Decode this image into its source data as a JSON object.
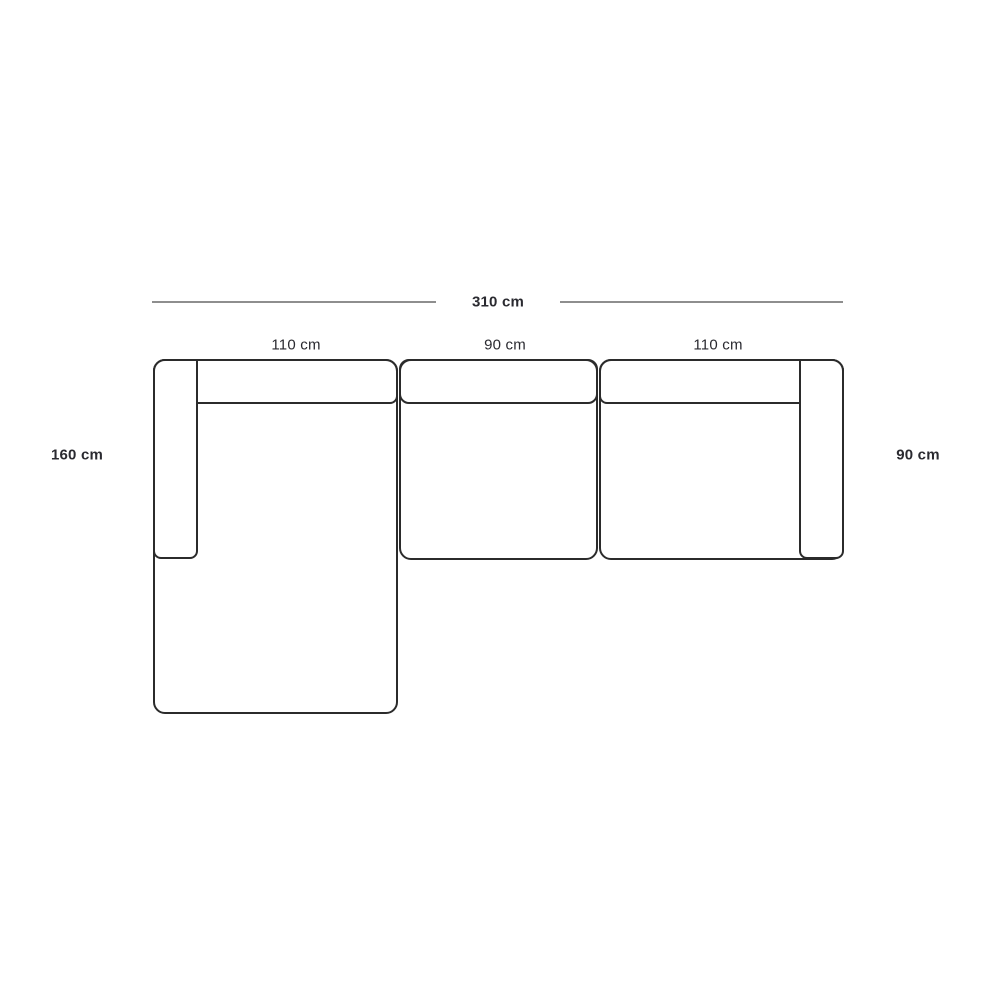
{
  "diagram": {
    "type": "sofa-top-view-dimensions",
    "overall_width_label": "310 cm",
    "modules": [
      {
        "name": "left-chaise-module",
        "width_label": "110 cm"
      },
      {
        "name": "middle-seat-module",
        "width_label": "90 cm"
      },
      {
        "name": "right-seat-module",
        "width_label": "110 cm"
      }
    ],
    "chaise_depth_label": "160 cm",
    "seat_depth_label": "90 cm",
    "colors": {
      "outline": "#2b2b2b",
      "dimension_line": "#8e8e8e",
      "text": "#2a2a30",
      "background": "#ffffff"
    }
  }
}
